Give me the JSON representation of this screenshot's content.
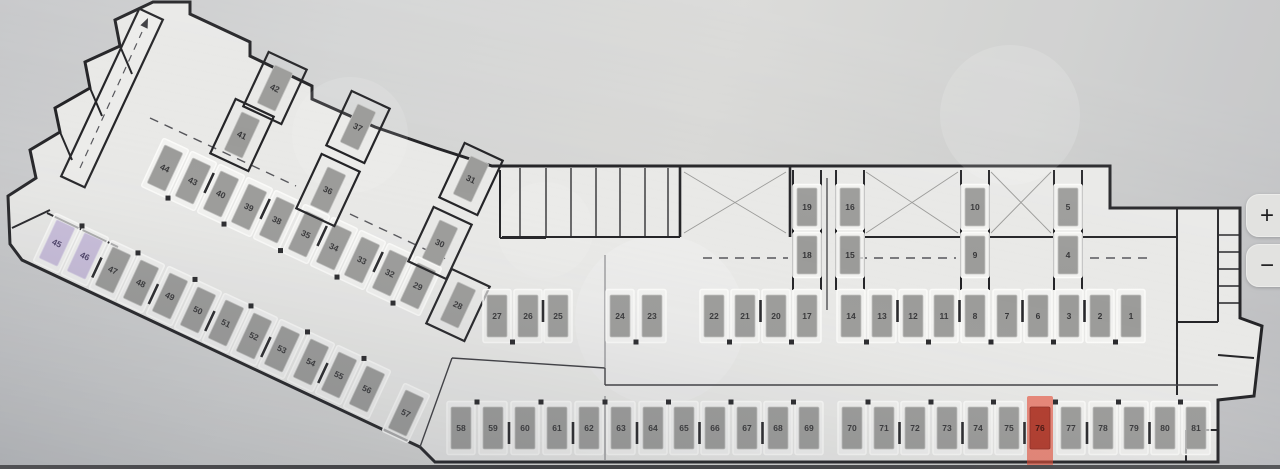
{
  "app": {
    "watermark": "Avito"
  },
  "map_controls": {
    "zoom_in_label": "+",
    "zoom_out_label": "−"
  },
  "floor_plan": {
    "selected_spot": "76",
    "colors": {
      "standard_fill": "#9b9b99",
      "standard_num": "#353537",
      "reserved_fill": "#c9bedb",
      "reserved_num": "#4a3f66",
      "selected_overlay": "#e8472f",
      "selected_fill": "#b23829",
      "selected_num": "#40100a",
      "separator": "#27272a",
      "bay_stroke": "#fbfbf9",
      "wall": "#232326"
    },
    "spots": [
      {
        "n": "44",
        "x": 165,
        "y": 168,
        "r": 25,
        "t": "std"
      },
      {
        "n": "43",
        "x": 193,
        "y": 181,
        "r": 25,
        "t": "std"
      },
      {
        "n": "40",
        "x": 221,
        "y": 194,
        "r": 25,
        "t": "std"
      },
      {
        "n": "39",
        "x": 249,
        "y": 207,
        "r": 25,
        "t": "std"
      },
      {
        "n": "38",
        "x": 277,
        "y": 220,
        "r": 25,
        "t": "std"
      },
      {
        "n": "35",
        "x": 306,
        "y": 234,
        "r": 25,
        "t": "std"
      },
      {
        "n": "34",
        "x": 334,
        "y": 247,
        "r": 25,
        "t": "std"
      },
      {
        "n": "33",
        "x": 362,
        "y": 260,
        "r": 25,
        "t": "std"
      },
      {
        "n": "32",
        "x": 390,
        "y": 273,
        "r": 25,
        "t": "std"
      },
      {
        "n": "29",
        "x": 418,
        "y": 286,
        "r": 25,
        "t": "std"
      },
      {
        "n": "42",
        "x": 275,
        "y": 88,
        "r": 25,
        "t": "std",
        "box": true
      },
      {
        "n": "41",
        "x": 242,
        "y": 135,
        "r": 25,
        "t": "std",
        "box": true
      },
      {
        "n": "37",
        "x": 358,
        "y": 127,
        "r": 25,
        "t": "std",
        "box": true
      },
      {
        "n": "36",
        "x": 328,
        "y": 190,
        "r": 25,
        "t": "std",
        "box": true
      },
      {
        "n": "31",
        "x": 471,
        "y": 179,
        "r": 25,
        "t": "std",
        "box": true
      },
      {
        "n": "30",
        "x": 440,
        "y": 243,
        "r": 25,
        "t": "std",
        "box": true
      },
      {
        "n": "28",
        "x": 458,
        "y": 305,
        "r": 25,
        "t": "std",
        "box": true
      },
      {
        "n": "45",
        "x": 57,
        "y": 243,
        "r": 25,
        "t": "acc"
      },
      {
        "n": "46",
        "x": 85,
        "y": 256,
        "r": 25,
        "t": "acc"
      },
      {
        "n": "47",
        "x": 113,
        "y": 270,
        "r": 25,
        "t": "std"
      },
      {
        "n": "48",
        "x": 141,
        "y": 283,
        "r": 25,
        "t": "std"
      },
      {
        "n": "49",
        "x": 170,
        "y": 296,
        "r": 25,
        "t": "std"
      },
      {
        "n": "50",
        "x": 198,
        "y": 310,
        "r": 25,
        "t": "std"
      },
      {
        "n": "51",
        "x": 226,
        "y": 323,
        "r": 25,
        "t": "std"
      },
      {
        "n": "52",
        "x": 254,
        "y": 336,
        "r": 25,
        "t": "std"
      },
      {
        "n": "53",
        "x": 282,
        "y": 349,
        "r": 25,
        "t": "std"
      },
      {
        "n": "54",
        "x": 311,
        "y": 362,
        "r": 25,
        "t": "std"
      },
      {
        "n": "55",
        "x": 339,
        "y": 375,
        "r": 25,
        "t": "std"
      },
      {
        "n": "56",
        "x": 367,
        "y": 389,
        "r": 25,
        "t": "std"
      },
      {
        "n": "57",
        "x": 406,
        "y": 413,
        "r": 25,
        "t": "std"
      },
      {
        "n": "19",
        "x": 807,
        "y": 207,
        "r": 0,
        "t": "std",
        "bh": 45,
        "sh": 38
      },
      {
        "n": "18",
        "x": 807,
        "y": 255,
        "r": 0,
        "t": "std",
        "bh": 45,
        "sh": 38
      },
      {
        "n": "16",
        "x": 850,
        "y": 207,
        "r": 0,
        "t": "std",
        "bh": 45,
        "sh": 38
      },
      {
        "n": "15",
        "x": 850,
        "y": 255,
        "r": 0,
        "t": "std",
        "bh": 45,
        "sh": 38
      },
      {
        "n": "10",
        "x": 975,
        "y": 207,
        "r": 0,
        "t": "std",
        "bh": 45,
        "sh": 38
      },
      {
        "n": "9",
        "x": 975,
        "y": 255,
        "r": 0,
        "t": "std",
        "bh": 45,
        "sh": 38
      },
      {
        "n": "5",
        "x": 1068,
        "y": 207,
        "r": 0,
        "t": "std",
        "bh": 45,
        "sh": 38
      },
      {
        "n": "4",
        "x": 1068,
        "y": 255,
        "r": 0,
        "t": "std",
        "bh": 45,
        "sh": 38
      },
      {
        "n": "27",
        "x": 497,
        "y": 316,
        "r": 0,
        "t": "std"
      },
      {
        "n": "26",
        "x": 528,
        "y": 316,
        "r": 0,
        "t": "std"
      },
      {
        "n": "25",
        "x": 558,
        "y": 316,
        "r": 0,
        "t": "std"
      },
      {
        "n": "24",
        "x": 620,
        "y": 316,
        "r": 0,
        "t": "std"
      },
      {
        "n": "23",
        "x": 652,
        "y": 316,
        "r": 0,
        "t": "std"
      },
      {
        "n": "22",
        "x": 714,
        "y": 316,
        "r": 0,
        "t": "std"
      },
      {
        "n": "21",
        "x": 745,
        "y": 316,
        "r": 0,
        "t": "std"
      },
      {
        "n": "20",
        "x": 776,
        "y": 316,
        "r": 0,
        "t": "std"
      },
      {
        "n": "17",
        "x": 807,
        "y": 316,
        "r": 0,
        "t": "std"
      },
      {
        "n": "14",
        "x": 851,
        "y": 316,
        "r": 0,
        "t": "std"
      },
      {
        "n": "13",
        "x": 882,
        "y": 316,
        "r": 0,
        "t": "std"
      },
      {
        "n": "12",
        "x": 913,
        "y": 316,
        "r": 0,
        "t": "std"
      },
      {
        "n": "11",
        "x": 944,
        "y": 316,
        "r": 0,
        "t": "std"
      },
      {
        "n": "8",
        "x": 975,
        "y": 316,
        "r": 0,
        "t": "std"
      },
      {
        "n": "7",
        "x": 1007,
        "y": 316,
        "r": 0,
        "t": "std"
      },
      {
        "n": "6",
        "x": 1038,
        "y": 316,
        "r": 0,
        "t": "std"
      },
      {
        "n": "3",
        "x": 1069,
        "y": 316,
        "r": 0,
        "t": "std"
      },
      {
        "n": "2",
        "x": 1100,
        "y": 316,
        "r": 0,
        "t": "std"
      },
      {
        "n": "1",
        "x": 1131,
        "y": 316,
        "r": 0,
        "t": "std"
      },
      {
        "n": "58",
        "x": 461,
        "y": 428,
        "r": 0,
        "t": "std"
      },
      {
        "n": "59",
        "x": 493,
        "y": 428,
        "r": 0,
        "t": "std"
      },
      {
        "n": "60",
        "x": 525,
        "y": 428,
        "r": 0,
        "t": "std"
      },
      {
        "n": "61",
        "x": 557,
        "y": 428,
        "r": 0,
        "t": "std"
      },
      {
        "n": "62",
        "x": 589,
        "y": 428,
        "r": 0,
        "t": "std"
      },
      {
        "n": "63",
        "x": 621,
        "y": 428,
        "r": 0,
        "t": "std"
      },
      {
        "n": "64",
        "x": 653,
        "y": 428,
        "r": 0,
        "t": "std"
      },
      {
        "n": "65",
        "x": 684,
        "y": 428,
        "r": 0,
        "t": "std"
      },
      {
        "n": "66",
        "x": 715,
        "y": 428,
        "r": 0,
        "t": "std"
      },
      {
        "n": "67",
        "x": 747,
        "y": 428,
        "r": 0,
        "t": "std"
      },
      {
        "n": "68",
        "x": 778,
        "y": 428,
        "r": 0,
        "t": "std"
      },
      {
        "n": "69",
        "x": 809,
        "y": 428,
        "r": 0,
        "t": "std"
      },
      {
        "n": "70",
        "x": 852,
        "y": 428,
        "r": 0,
        "t": "std"
      },
      {
        "n": "71",
        "x": 884,
        "y": 428,
        "r": 0,
        "t": "std"
      },
      {
        "n": "72",
        "x": 915,
        "y": 428,
        "r": 0,
        "t": "std"
      },
      {
        "n": "73",
        "x": 947,
        "y": 428,
        "r": 0,
        "t": "std"
      },
      {
        "n": "74",
        "x": 978,
        "y": 428,
        "r": 0,
        "t": "std"
      },
      {
        "n": "75",
        "x": 1009,
        "y": 428,
        "r": 0,
        "t": "std"
      },
      {
        "n": "76",
        "x": 1040,
        "y": 428,
        "r": 0,
        "t": "sel"
      },
      {
        "n": "77",
        "x": 1071,
        "y": 428,
        "r": 0,
        "t": "std"
      },
      {
        "n": "78",
        "x": 1103,
        "y": 428,
        "r": 0,
        "t": "std"
      },
      {
        "n": "79",
        "x": 1134,
        "y": 428,
        "r": 0,
        "t": "std"
      },
      {
        "n": "80",
        "x": 1165,
        "y": 428,
        "r": 0,
        "t": "std"
      },
      {
        "n": "81",
        "x": 1196,
        "y": 428,
        "r": 0,
        "t": "std"
      }
    ],
    "rows": [
      {
        "ids": [
          "44",
          "43",
          "40",
          "39",
          "38",
          "35",
          "34",
          "33",
          "32",
          "29"
        ],
        "m": 1
      },
      {
        "ids": [
          "45",
          "46",
          "47",
          "48",
          "49",
          "50",
          "51",
          "52",
          "53",
          "54",
          "55",
          "56"
        ],
        "m": -1
      },
      {
        "ids": [
          "27",
          "26",
          "25"
        ],
        "m": 1
      },
      {
        "ids": [
          "24",
          "23"
        ],
        "m": 1
      },
      {
        "ids": [
          "22",
          "21",
          "20",
          "17"
        ],
        "m": 1
      },
      {
        "ids": [
          "14",
          "13",
          "12",
          "11",
          "8",
          "7",
          "6",
          "3",
          "2",
          "1"
        ],
        "m": 1
      },
      {
        "ids": [
          "58",
          "59",
          "60",
          "61",
          "62",
          "63",
          "64",
          "65",
          "66",
          "67",
          "68",
          "69"
        ],
        "m": -1
      },
      {
        "ids": [
          "70",
          "71",
          "72",
          "73",
          "74",
          "75",
          "76",
          "77",
          "78",
          "79",
          "80",
          "81"
        ],
        "m": -1
      }
    ]
  }
}
